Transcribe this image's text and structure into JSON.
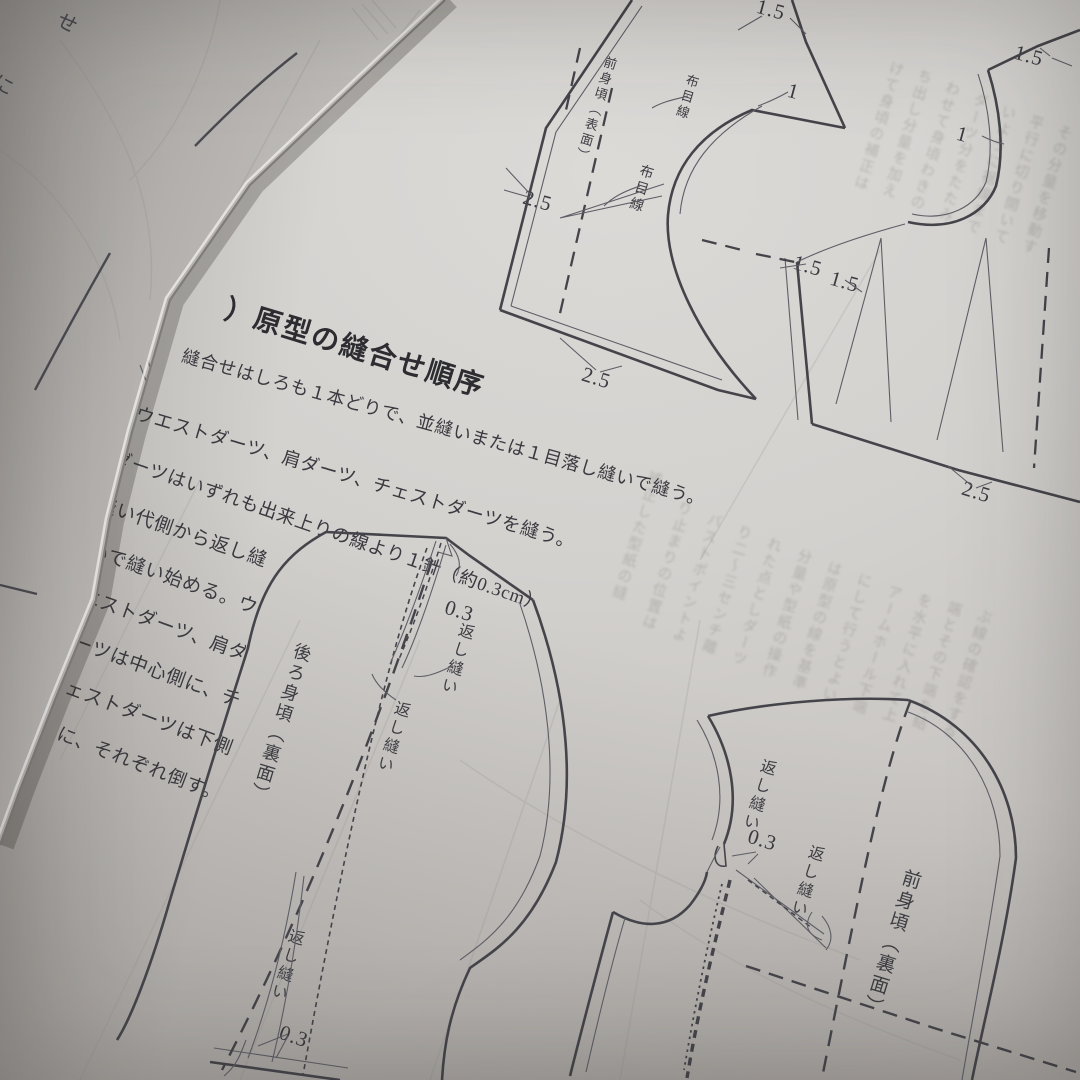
{
  "page": {
    "heading": "）原型の縫合せ順序",
    "body_lines": [
      {
        "t": "縫合せはしろも１本どりで、並縫いまたは１目落し縫いで縫う。",
        "x": 186,
        "y": 342,
        "r": 15.5,
        "fs": 18
      },
      {
        "t": "ウエストダーツ、肩ダーツ、チェストダーツを縫う。",
        "x": 140,
        "y": 400,
        "r": 16.5,
        "fs": 18.5
      },
      {
        "t": "ダーツはいずれも出来上りの線より１針（約0.3cm）",
        "x": 118,
        "y": 444,
        "r": 19,
        "fs": 18.5
      },
      {
        "t": "縫い代側から返し縫",
        "x": 103,
        "y": 489,
        "r": 19,
        "fs": 19
      },
      {
        "t": "いで縫い始める。ウ",
        "x": 95,
        "y": 535,
        "r": 19.5,
        "fs": 19
      },
      {
        "t": "エストダーツ、肩ダ",
        "x": 87,
        "y": 581,
        "r": 20,
        "fs": 19
      },
      {
        "t": "ーツは中心側に、チ",
        "x": 79,
        "y": 627,
        "r": 20,
        "fs": 19
      },
      {
        "t": "ェストダーツは下側",
        "x": 71,
        "y": 673,
        "r": 20.5,
        "fs": 19
      },
      {
        "t": "に、それぞれ倒す。",
        "x": 63,
        "y": 719,
        "r": 21,
        "fs": 19
      }
    ]
  },
  "labels": {
    "vlabels": [
      {
        "t": "前身頃（表面）",
        "x": 604,
        "y": 54,
        "fs": 13
      },
      {
        "t": "布目線",
        "x": 686,
        "y": 72,
        "fs": 13
      },
      {
        "t": "布目線",
        "x": 640,
        "y": 162,
        "fs": 14
      },
      {
        "t": "後ろ身頃（裏面）",
        "x": 294,
        "y": 640,
        "fs": 18
      },
      {
        "t": "返し縫い",
        "x": 458,
        "y": 620,
        "fs": 16
      },
      {
        "t": "返し縫い",
        "x": 394,
        "y": 698,
        "fs": 16
      },
      {
        "t": "返し縫い",
        "x": 288,
        "y": 926,
        "fs": 16
      },
      {
        "t": "返し縫い",
        "x": 760,
        "y": 756,
        "fs": 16
      },
      {
        "t": "返し縫い",
        "x": 808,
        "y": 842,
        "fs": 16
      },
      {
        "t": "前身頃（裏面）",
        "x": 902,
        "y": 866,
        "fs": 19
      }
    ],
    "dims": [
      {
        "t": "1.5",
        "x": 760,
        "y": -6,
        "r": 15
      },
      {
        "t": "1",
        "x": 791,
        "y": 78,
        "r": 15
      },
      {
        "t": "2.5",
        "x": 527,
        "y": 185,
        "r": 16
      },
      {
        "t": "2.5",
        "x": 586,
        "y": 362,
        "r": 17
      },
      {
        "t": "1.5",
        "x": 1018,
        "y": 40,
        "r": 15
      },
      {
        "t": "1",
        "x": 960,
        "y": 121,
        "r": 15
      },
      {
        "t": "1.5",
        "x": 797,
        "y": 250,
        "r": 16
      },
      {
        "t": "1.5",
        "x": 834,
        "y": 266,
        "r": 16
      },
      {
        "t": "2.5",
        "x": 966,
        "y": 476,
        "r": 17
      },
      {
        "t": "0.3",
        "x": 449,
        "y": 595,
        "r": 17
      },
      {
        "t": "0.3",
        "x": 284,
        "y": 1020,
        "r": 19
      },
      {
        "t": "0.3",
        "x": 752,
        "y": 824,
        "r": 17
      }
    ]
  },
  "ghost": {
    "columns": [
      {
        "t": "けて身頃の補正は",
        "x": 888,
        "y": 58,
        "h": 150
      },
      {
        "t": "ち出し分量を加え",
        "x": 916,
        "y": 66,
        "h": 180
      },
      {
        "t": "わせて身頃わきの",
        "x": 944,
        "y": 78,
        "h": 200
      },
      {
        "t": "ダーツ分をたたみ",
        "x": 972,
        "y": 90,
        "h": 190
      },
      {
        "t": "いように裾線まで",
        "x": 1000,
        "y": 102,
        "h": 180
      },
      {
        "t": "平行に切り開いて",
        "x": 1028,
        "y": 112,
        "h": 160
      },
      {
        "t": "その分量を移動す",
        "x": 1056,
        "y": 122,
        "h": 150
      },
      {
        "t": "補正した型紙の縫",
        "x": 646,
        "y": 468,
        "h": 160
      },
      {
        "t": "り止まりの位置は",
        "x": 676,
        "y": 498,
        "h": 210
      },
      {
        "t": "バストポイントよ",
        "x": 706,
        "y": 510,
        "h": 230
      },
      {
        "t": "り二〜三センチ離",
        "x": 736,
        "y": 522,
        "h": 240
      },
      {
        "t": "れた点としダーツ",
        "x": 766,
        "y": 534,
        "h": 240
      },
      {
        "t": "分量や型紙の操作",
        "x": 796,
        "y": 546,
        "h": 230
      },
      {
        "t": "は原型の線を基準",
        "x": 826,
        "y": 558,
        "h": 220
      },
      {
        "t": "にして行うとよい",
        "x": 856,
        "y": 570,
        "h": 210
      },
      {
        "t": "アームホール下端",
        "x": 886,
        "y": 582,
        "h": 200
      },
      {
        "t": "を水平に入れて上",
        "x": 916,
        "y": 590,
        "h": 190
      },
      {
        "t": "端とその下端を結",
        "x": 946,
        "y": 598,
        "h": 180
      },
      {
        "t": "ぶ線の確認をする",
        "x": 976,
        "y": 606,
        "h": 170
      }
    ]
  },
  "left_page": {
    "corner_chars": [
      {
        "t": "せ",
        "x": 66,
        "y": 4,
        "r": 28
      },
      {
        "t": "に",
        "x": 2,
        "y": 66,
        "r": 28
      }
    ]
  },
  "colors": {
    "paper": "#d3d1ce",
    "ink_bold": "#44444a",
    "ink_thin": "#5e5e66",
    "text_ink": "#39393f"
  }
}
